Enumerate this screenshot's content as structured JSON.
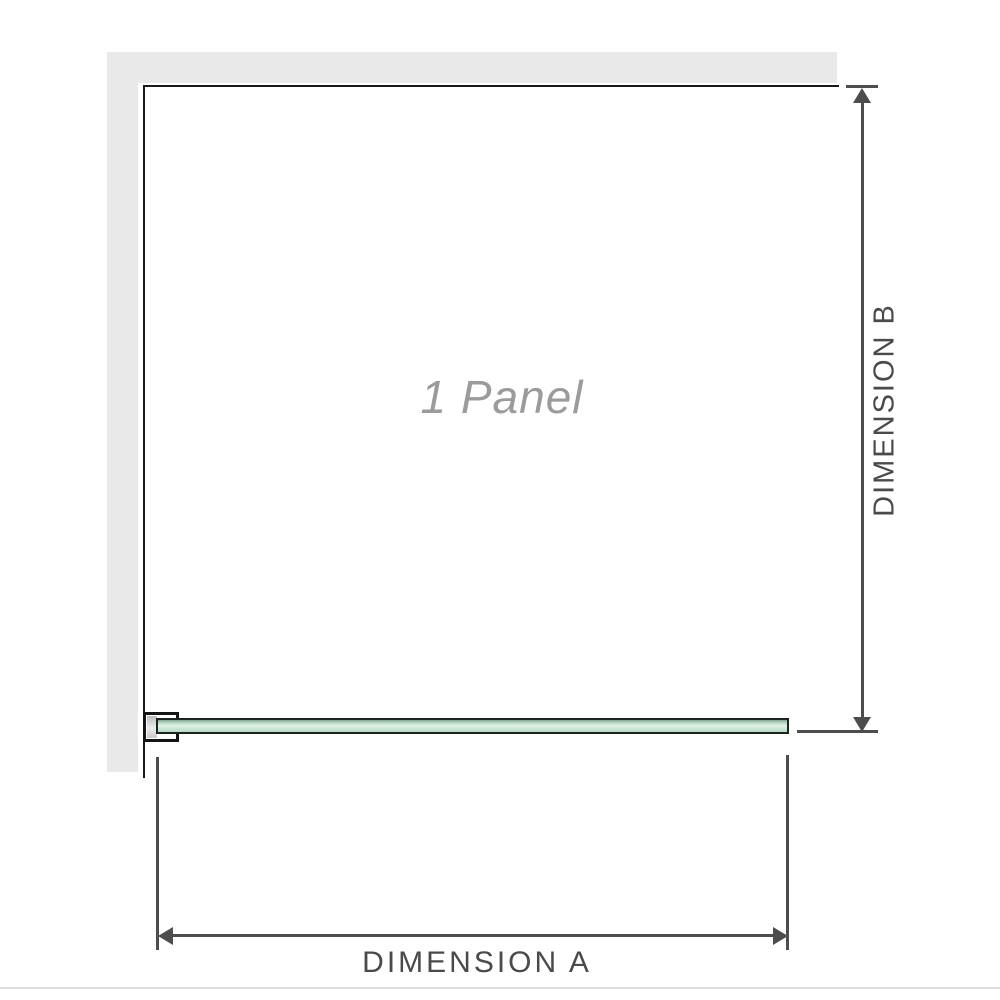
{
  "diagram": {
    "panel_label": "1 Panel",
    "dimension_a_label": "DIMENSION A",
    "dimension_b_label": "DIMENSION B"
  },
  "colors": {
    "wall": "#e9e9e9",
    "panel_outline": "#1a1a1a",
    "glass_fill": "#b7dbc5",
    "glass_highlight": "#e2f1e6",
    "glass_edge": "#7fa492",
    "dimension_line": "#4d4d4d",
    "label_text": "#4a4a4a",
    "panel_text": "#9b9b9b",
    "divider": "#dedede"
  }
}
